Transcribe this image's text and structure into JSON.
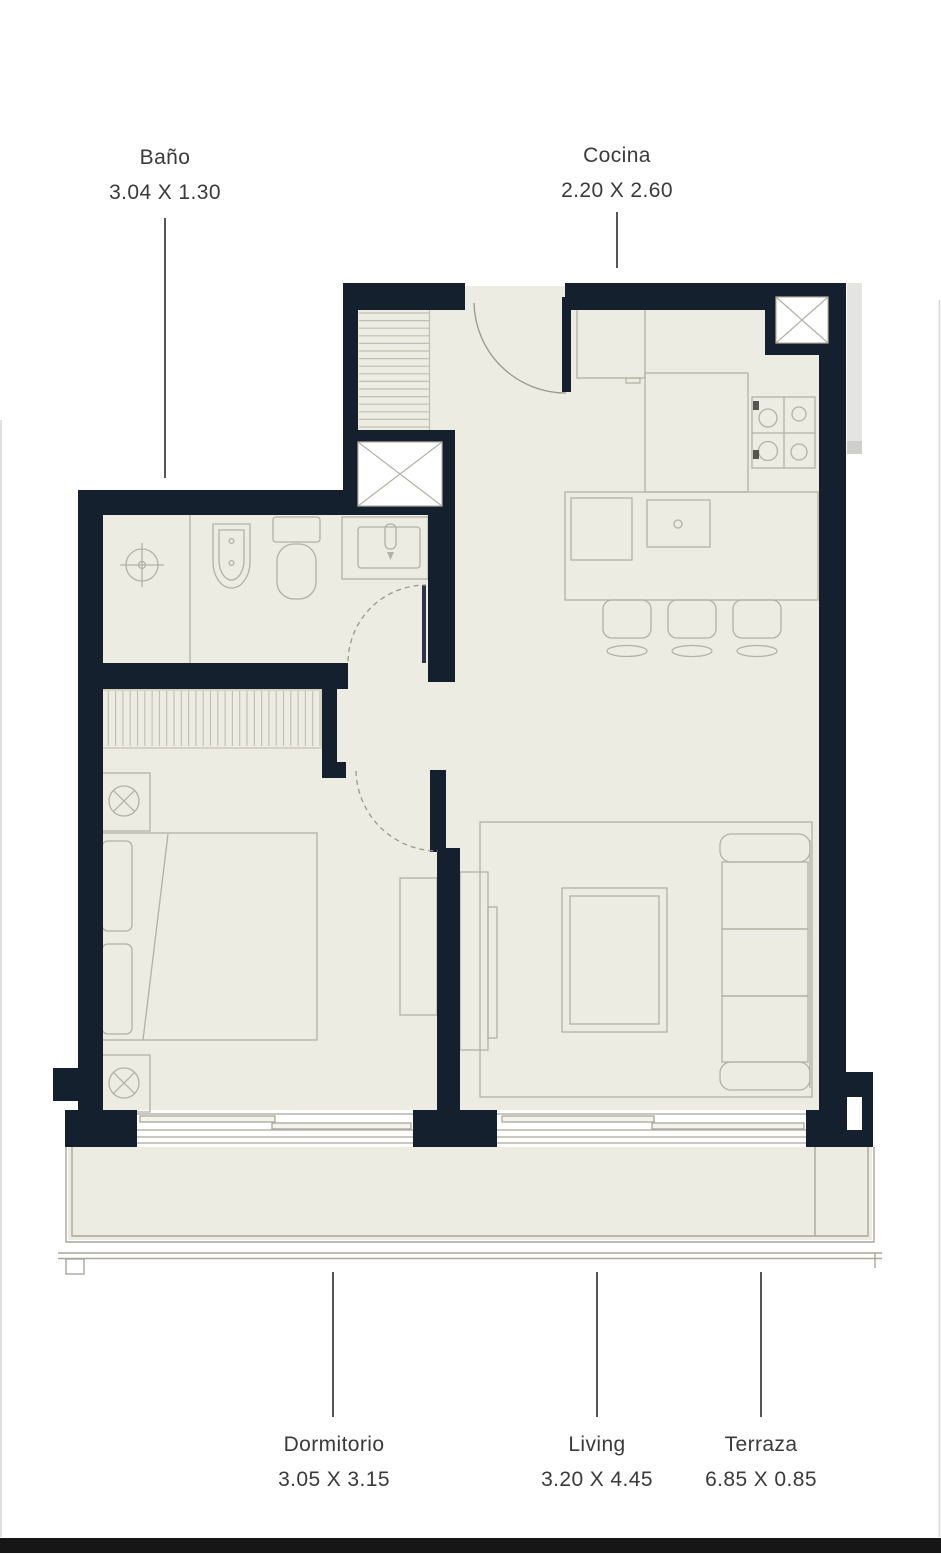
{
  "rooms": [
    {
      "id": "bano",
      "name": "Baño",
      "dimensions": "3.04 X 1.30"
    },
    {
      "id": "cocina",
      "name": "Cocina",
      "dimensions": "2.20 X 2.60"
    },
    {
      "id": "dormitorio",
      "name": "Dormitorio",
      "dimensions": "3.05 X 3.15"
    },
    {
      "id": "living",
      "name": "Living",
      "dimensions": "3.20 X 4.45"
    },
    {
      "id": "terraza",
      "name": "Terraza",
      "dimensions": "6.85 X 0.85"
    }
  ],
  "colors": {
    "wall": "#15202f",
    "floor": "#edece2",
    "furniture_line": "#b3b1a4",
    "hatch_line": "#c0beb1",
    "leader_line": "#2b2b2b",
    "label_text": "#3a3a3a",
    "background": "#ffffff",
    "bottom_bar": "#161616"
  }
}
